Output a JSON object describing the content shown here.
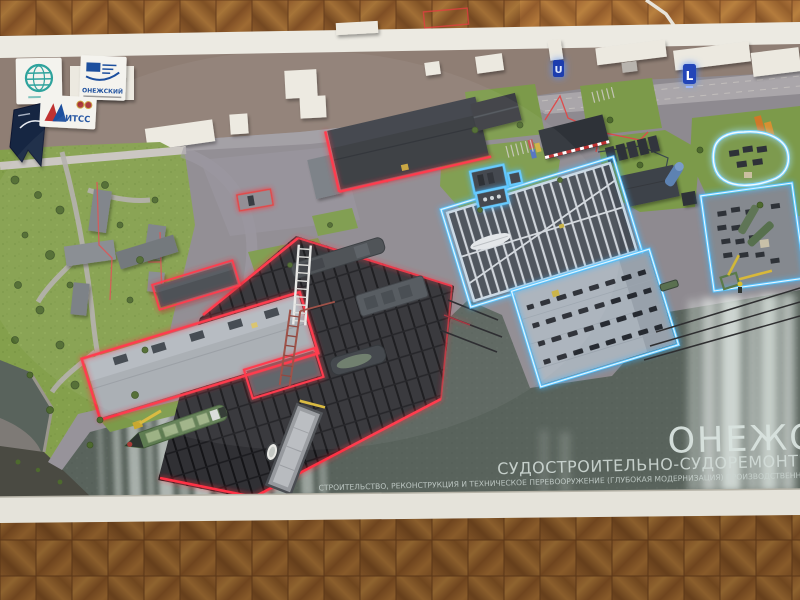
{
  "scene": {
    "description": "Exhibition scale model (maquette) of the Onega shipbuilding and ship-repair yard photographed from above on a white display table standing on herringbone parquet flooring",
    "model_caption": {
      "line1": "ОНЕЖСКИ",
      "line2": "СУДОСТРОИТЕЛЬНО-СУДОРЕМОНТНЫЙ ЗА",
      "line3": "СТРОИТЕЛЬСТВО, РЕКОНСТРУКЦИЯ И ТЕХНИЧЕСКОЕ ПЕРЕВООРУЖЕНИЕ (ГЛУБОКАЯ МОДЕРНИЗАЦИЯ) ПРОИЗВОДСТВЕННЫХ МО"
    },
    "logos": [
      {
        "id": "globe-logo",
        "label": ""
      },
      {
        "id": "onezhsky-logo",
        "label": "ОНЕЖСКИЙ"
      },
      {
        "id": "pennant-logo",
        "label": ""
      },
      {
        "id": "itss-logo",
        "label": "ИТСС"
      }
    ],
    "lit_signs": [
      {
        "glyph": "U"
      },
      {
        "glyph": "L"
      }
    ],
    "colors": {
      "red_neon": "#ff3344",
      "blue_neon": "#58c4ff",
      "bright_blue_white": "#eef9ff",
      "water": "#59635c",
      "board_asphalt": "#8e8a90",
      "ground_brown": "#8f7e74",
      "grass": "#84a04c",
      "parquet_brown": "#9c6434",
      "frame_white": "#eceae2",
      "logo_blue": "#1d4f9e",
      "logo_teal": "#2fa39d",
      "crane_yellow": "#d8b838",
      "ship_green": "#5f7d52"
    }
  }
}
